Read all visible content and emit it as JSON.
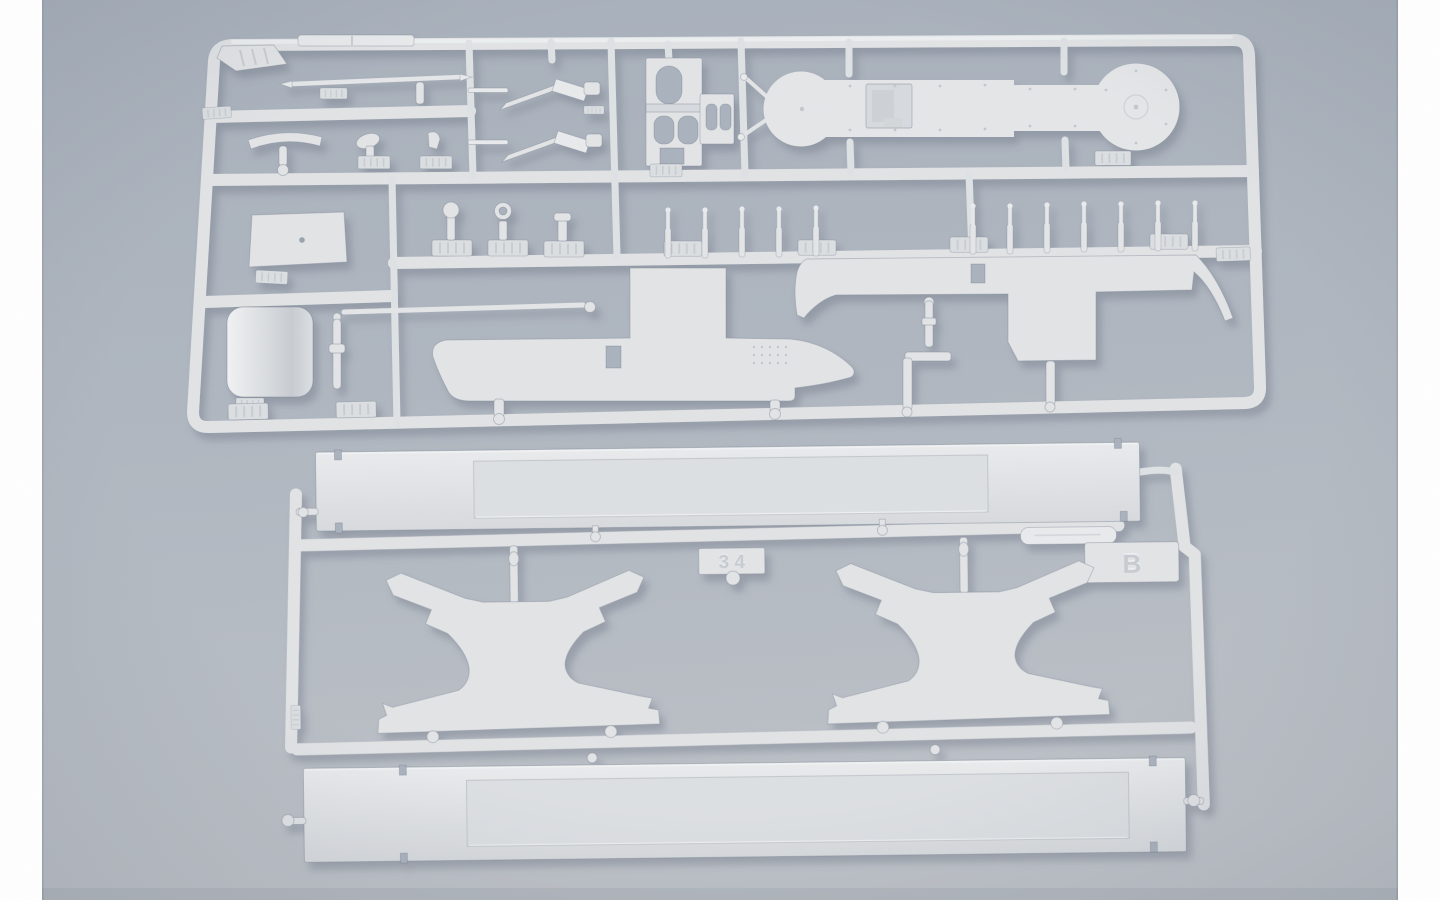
{
  "scene": {
    "description": "Product photograph of two light-gray injection-molded plastic model kit sprues (ship model parts) lying on a blue-gray surface, with white page margins on the left and right edges",
    "colors": {
      "page_margin": "#ffffff",
      "photo_background_top": "#a8b0bb",
      "photo_background_bottom": "#bdc1c7",
      "plastic": "#e2e4e6",
      "plastic_shadow": "#5d6878"
    }
  },
  "sprue_top": {
    "name": "detail-parts-sprue",
    "parts": [
      "mast-rod",
      "tee-bar",
      "small-fittings-with-number-tabs",
      "gun-assemblies",
      "bridge-tower",
      "oval-deck-platform",
      "row-of-small-pins",
      "deck-plate",
      "funnel-drum",
      "side-rod",
      "boom-rod",
      "hull-side-left",
      "hull-side-right",
      "crane-rod"
    ]
  },
  "sprue_bottom": {
    "name": "sprue-b",
    "letter_tab": "B",
    "number_tab": "3 4",
    "parts": [
      "upper-deck-plank",
      "lower-deck-plank",
      "hull-cradle-left",
      "hull-cradle-right",
      "spacer-strip"
    ]
  }
}
